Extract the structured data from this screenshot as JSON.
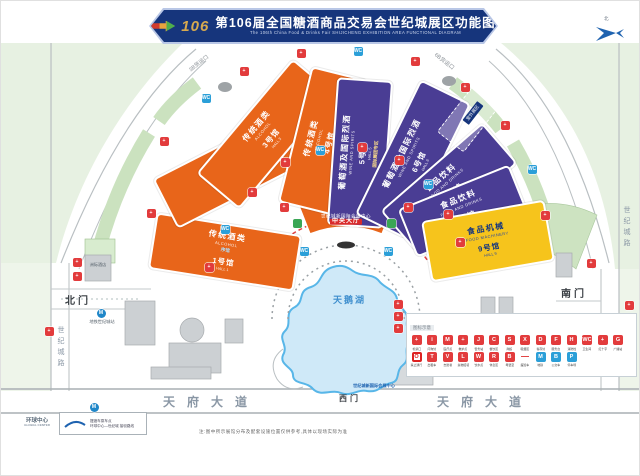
{
  "title": {
    "logo": "106",
    "zh": "第106届全国糖酒商品交易会世纪城展区功能图",
    "en": "The 106th China Food & Drinks Fair SHIJICHENG EXHIBITION AREA FUNCTIONAL DIAGRAM"
  },
  "compass": {
    "north": "北"
  },
  "halls": [
    {
      "name": "1号馆",
      "name_en": "HALL 1",
      "category": "传统酒类",
      "category_en": "ALCOHOL",
      "extra": "序馆"
    },
    {
      "name": "2号馆",
      "name_en": "HALL 2",
      "category": "传统酒类",
      "category_en": "ALCOHOL"
    },
    {
      "name": "3号馆",
      "name_en": "HALL 3",
      "category": "传统酒类",
      "category_en": "ALCOHOL"
    },
    {
      "name": "4号馆",
      "name_en": "HALL 4",
      "category": "传统酒类",
      "category_en": "ALCOHOL"
    },
    {
      "name": "5号馆",
      "name_en": "HALL 5",
      "category": "葡萄酒及国际烈酒",
      "category_en": "WINE AND SPIRITS",
      "extra": "国际展团专区"
    },
    {
      "name": "6号馆",
      "name_en": "HALL 6",
      "category": "葡萄酒及国际烈酒",
      "category_en": "WINE AND SPIRITS"
    },
    {
      "name": "7号馆",
      "name_en": "HALL 7",
      "category": "食品饮料",
      "category_en": "FOOD AND DRINKS"
    },
    {
      "name": "8号馆",
      "name_en": "HALL 8",
      "category": "食品饮料",
      "category_en": "FOOD AND DRINKS"
    },
    {
      "name": "9号馆",
      "name_en": "HALL 9",
      "category": "食品机械",
      "category_en": "FOOD MACHINERY"
    }
  ],
  "central_banner": {
    "line1": "世纪城新国际会展中心",
    "line2": "中央大厅"
  },
  "outdoor_area": {
    "label": "室外展区"
  },
  "lake": {
    "label": "天鹅湖"
  },
  "gates": {
    "north": "北门",
    "south": "南门",
    "west": "西门"
  },
  "roads": {
    "avenue": "天府大道",
    "century_left": "世纪城路",
    "century_right": "世纪城路"
  },
  "freight_gates": {
    "left": "3B货运口",
    "right": "6B货运口"
  },
  "metro": {
    "label": "地铁世纪城站"
  },
  "hotel": {
    "label": "洲际酒店"
  },
  "west_sign": {
    "label": "世纪城新国际会展中心"
  },
  "global_center": {
    "label": "环球中心",
    "label_en": "GLOBAL CENTER",
    "shuttle": "摆渡车乘车点",
    "route": "环球中心—世纪城 接驳路线"
  },
  "note": "注:图中所示展馆分布及配套设施位置仅供参考,具体以现场实际为准",
  "legend": {
    "header": "图标示意",
    "row1": [
      {
        "g": "+",
        "k": "r",
        "label": "检票口"
      },
      {
        "g": "i",
        "k": "r",
        "label": "问询处"
      },
      {
        "g": "M",
        "k": "r",
        "label": "医疗点"
      },
      {
        "g": "+",
        "k": "r",
        "label": "救护点"
      },
      {
        "g": "J",
        "k": "r",
        "label": "警务站"
      },
      {
        "g": "C",
        "k": "r",
        "label": "餐饮区"
      },
      {
        "g": "S",
        "k": "r",
        "label": "商超"
      },
      {
        "g": "X",
        "k": "r",
        "label": "吸烟区"
      },
      {
        "g": "D",
        "k": "r",
        "label": "寄存处"
      },
      {
        "g": "F",
        "k": "r",
        "label": "服务台"
      },
      {
        "g": "H",
        "k": "r",
        "label": "消防栓"
      },
      {
        "g": "WC",
        "k": "r",
        "label": "卫生间"
      },
      {
        "g": "+",
        "k": "r",
        "label": "红十字"
      },
      {
        "g": "G",
        "k": "r",
        "label": "广播站"
      }
    ],
    "row2": [
      {
        "g": "O",
        "k": "o",
        "label": "禁止通行"
      },
      {
        "g": "T",
        "k": "r",
        "label": "出租车"
      },
      {
        "g": "V",
        "k": "r",
        "label": "志愿者"
      },
      {
        "g": "L",
        "k": "r",
        "label": "失物招领"
      },
      {
        "g": "W",
        "k": "r",
        "label": "饮水点"
      },
      {
        "g": "R",
        "k": "r",
        "label": "休息区"
      },
      {
        "g": "B",
        "k": "r",
        "label": "母婴室"
      },
      {
        "g": "—",
        "k": "dash",
        "label": "摆渡车"
      },
      {
        "g": "M",
        "k": "b",
        "label": "地铁"
      },
      {
        "g": "B",
        "k": "b",
        "label": "公交车"
      },
      {
        "g": "P",
        "k": "b",
        "label": "停车场"
      }
    ]
  },
  "map_icons": [
    {
      "x": 150,
      "y": 212,
      "k": "r",
      "g": "+"
    },
    {
      "x": 163,
      "y": 140,
      "k": "r",
      "g": "+"
    },
    {
      "x": 205,
      "y": 97,
      "k": "b",
      "g": "WC"
    },
    {
      "x": 243,
      "y": 70,
      "k": "r",
      "g": "+"
    },
    {
      "x": 300,
      "y": 52,
      "k": "r",
      "g": "+"
    },
    {
      "x": 357,
      "y": 50,
      "k": "b",
      "g": "WC"
    },
    {
      "x": 414,
      "y": 60,
      "k": "r",
      "g": "+"
    },
    {
      "x": 464,
      "y": 86,
      "k": "r",
      "g": "+"
    },
    {
      "x": 504,
      "y": 124,
      "k": "r",
      "g": "+"
    },
    {
      "x": 531,
      "y": 168,
      "k": "b",
      "g": "WC"
    },
    {
      "x": 544,
      "y": 214,
      "k": "r",
      "g": "+"
    },
    {
      "x": 208,
      "y": 266,
      "k": "r",
      "g": "+"
    },
    {
      "x": 224,
      "y": 228,
      "k": "b",
      "g": "WC"
    },
    {
      "x": 251,
      "y": 191,
      "k": "r",
      "g": "+"
    },
    {
      "x": 284,
      "y": 161,
      "k": "r",
      "g": "+"
    },
    {
      "x": 319,
      "y": 149,
      "k": "b",
      "g": "WC"
    },
    {
      "x": 361,
      "y": 146,
      "k": "r",
      "g": "+"
    },
    {
      "x": 398,
      "y": 159,
      "k": "r",
      "g": "+"
    },
    {
      "x": 427,
      "y": 183,
      "k": "b",
      "g": "WC"
    },
    {
      "x": 447,
      "y": 213,
      "k": "r",
      "g": "+"
    },
    {
      "x": 459,
      "y": 241,
      "k": "r",
      "g": "+"
    },
    {
      "x": 283,
      "y": 206,
      "k": "r",
      "g": "+"
    },
    {
      "x": 407,
      "y": 206,
      "k": "r",
      "g": "+"
    },
    {
      "x": 303,
      "y": 250,
      "k": "b",
      "g": "WC"
    },
    {
      "x": 387,
      "y": 250,
      "k": "b",
      "g": "WC"
    },
    {
      "x": 296,
      "y": 222,
      "k": "g",
      "g": ""
    },
    {
      "x": 390,
      "y": 222,
      "k": "g",
      "g": ""
    },
    {
      "x": 76,
      "y": 261,
      "k": "r",
      "g": "+"
    },
    {
      "x": 76,
      "y": 275,
      "k": "r",
      "g": "+"
    },
    {
      "x": 48,
      "y": 330,
      "k": "r",
      "g": "+"
    },
    {
      "x": 590,
      "y": 262,
      "k": "r",
      "g": "+"
    },
    {
      "x": 628,
      "y": 304,
      "k": "r",
      "g": "+"
    },
    {
      "x": 397,
      "y": 303,
      "k": "r",
      "g": "+"
    },
    {
      "x": 397,
      "y": 315,
      "k": "r",
      "g": "+"
    },
    {
      "x": 397,
      "y": 327,
      "k": "r",
      "g": "+"
    },
    {
      "x": 100,
      "y": 312,
      "k": "m",
      "g": "M"
    },
    {
      "x": 93,
      "y": 406,
      "k": "m",
      "g": "M"
    }
  ]
}
